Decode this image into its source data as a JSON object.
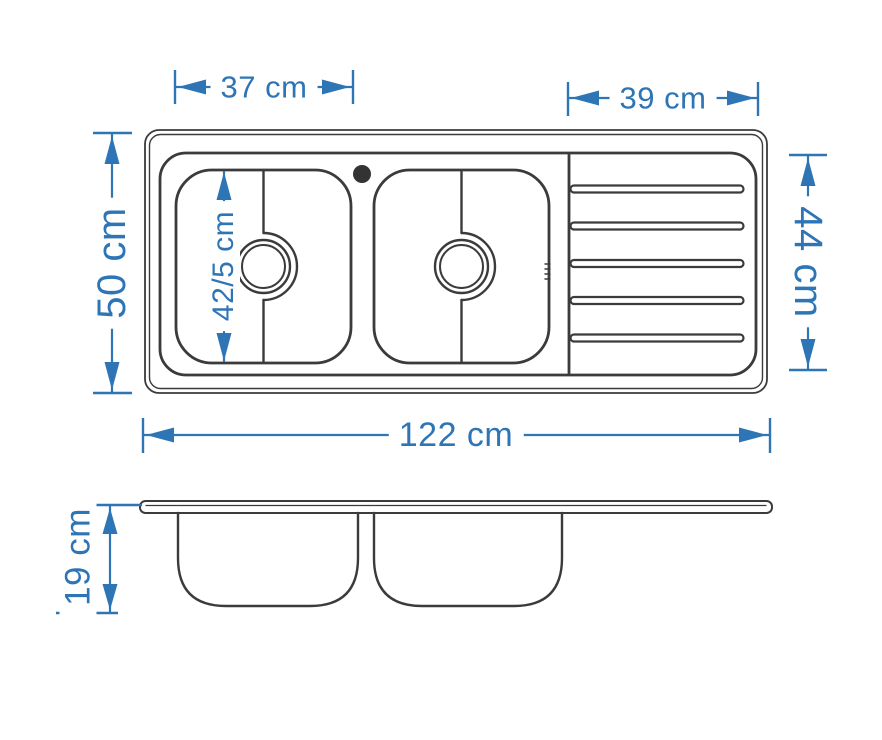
{
  "diagram": {
    "subject": "double-bowl kitchen sink with right-hand drainboard, dimensioned technical drawing",
    "colors": {
      "dimension_accent": "#2E75B6",
      "outline": "#3B3B3B",
      "background": "#FFFFFF"
    },
    "features": {
      "bowls": 2,
      "drainboard_grooves": 5,
      "faucet_holes": 1
    },
    "top_view": {
      "dimensions": {
        "left_bowl_width": "37 cm",
        "drainboard_width": "39 cm",
        "overall_depth": "50 cm",
        "bowl_inner_length": "42/5 cm",
        "drainboard_depth": "44 cm",
        "overall_length": "122 cm"
      }
    },
    "side_view": {
      "dimensions": {
        "bowl_depth": "19 cm"
      }
    }
  }
}
